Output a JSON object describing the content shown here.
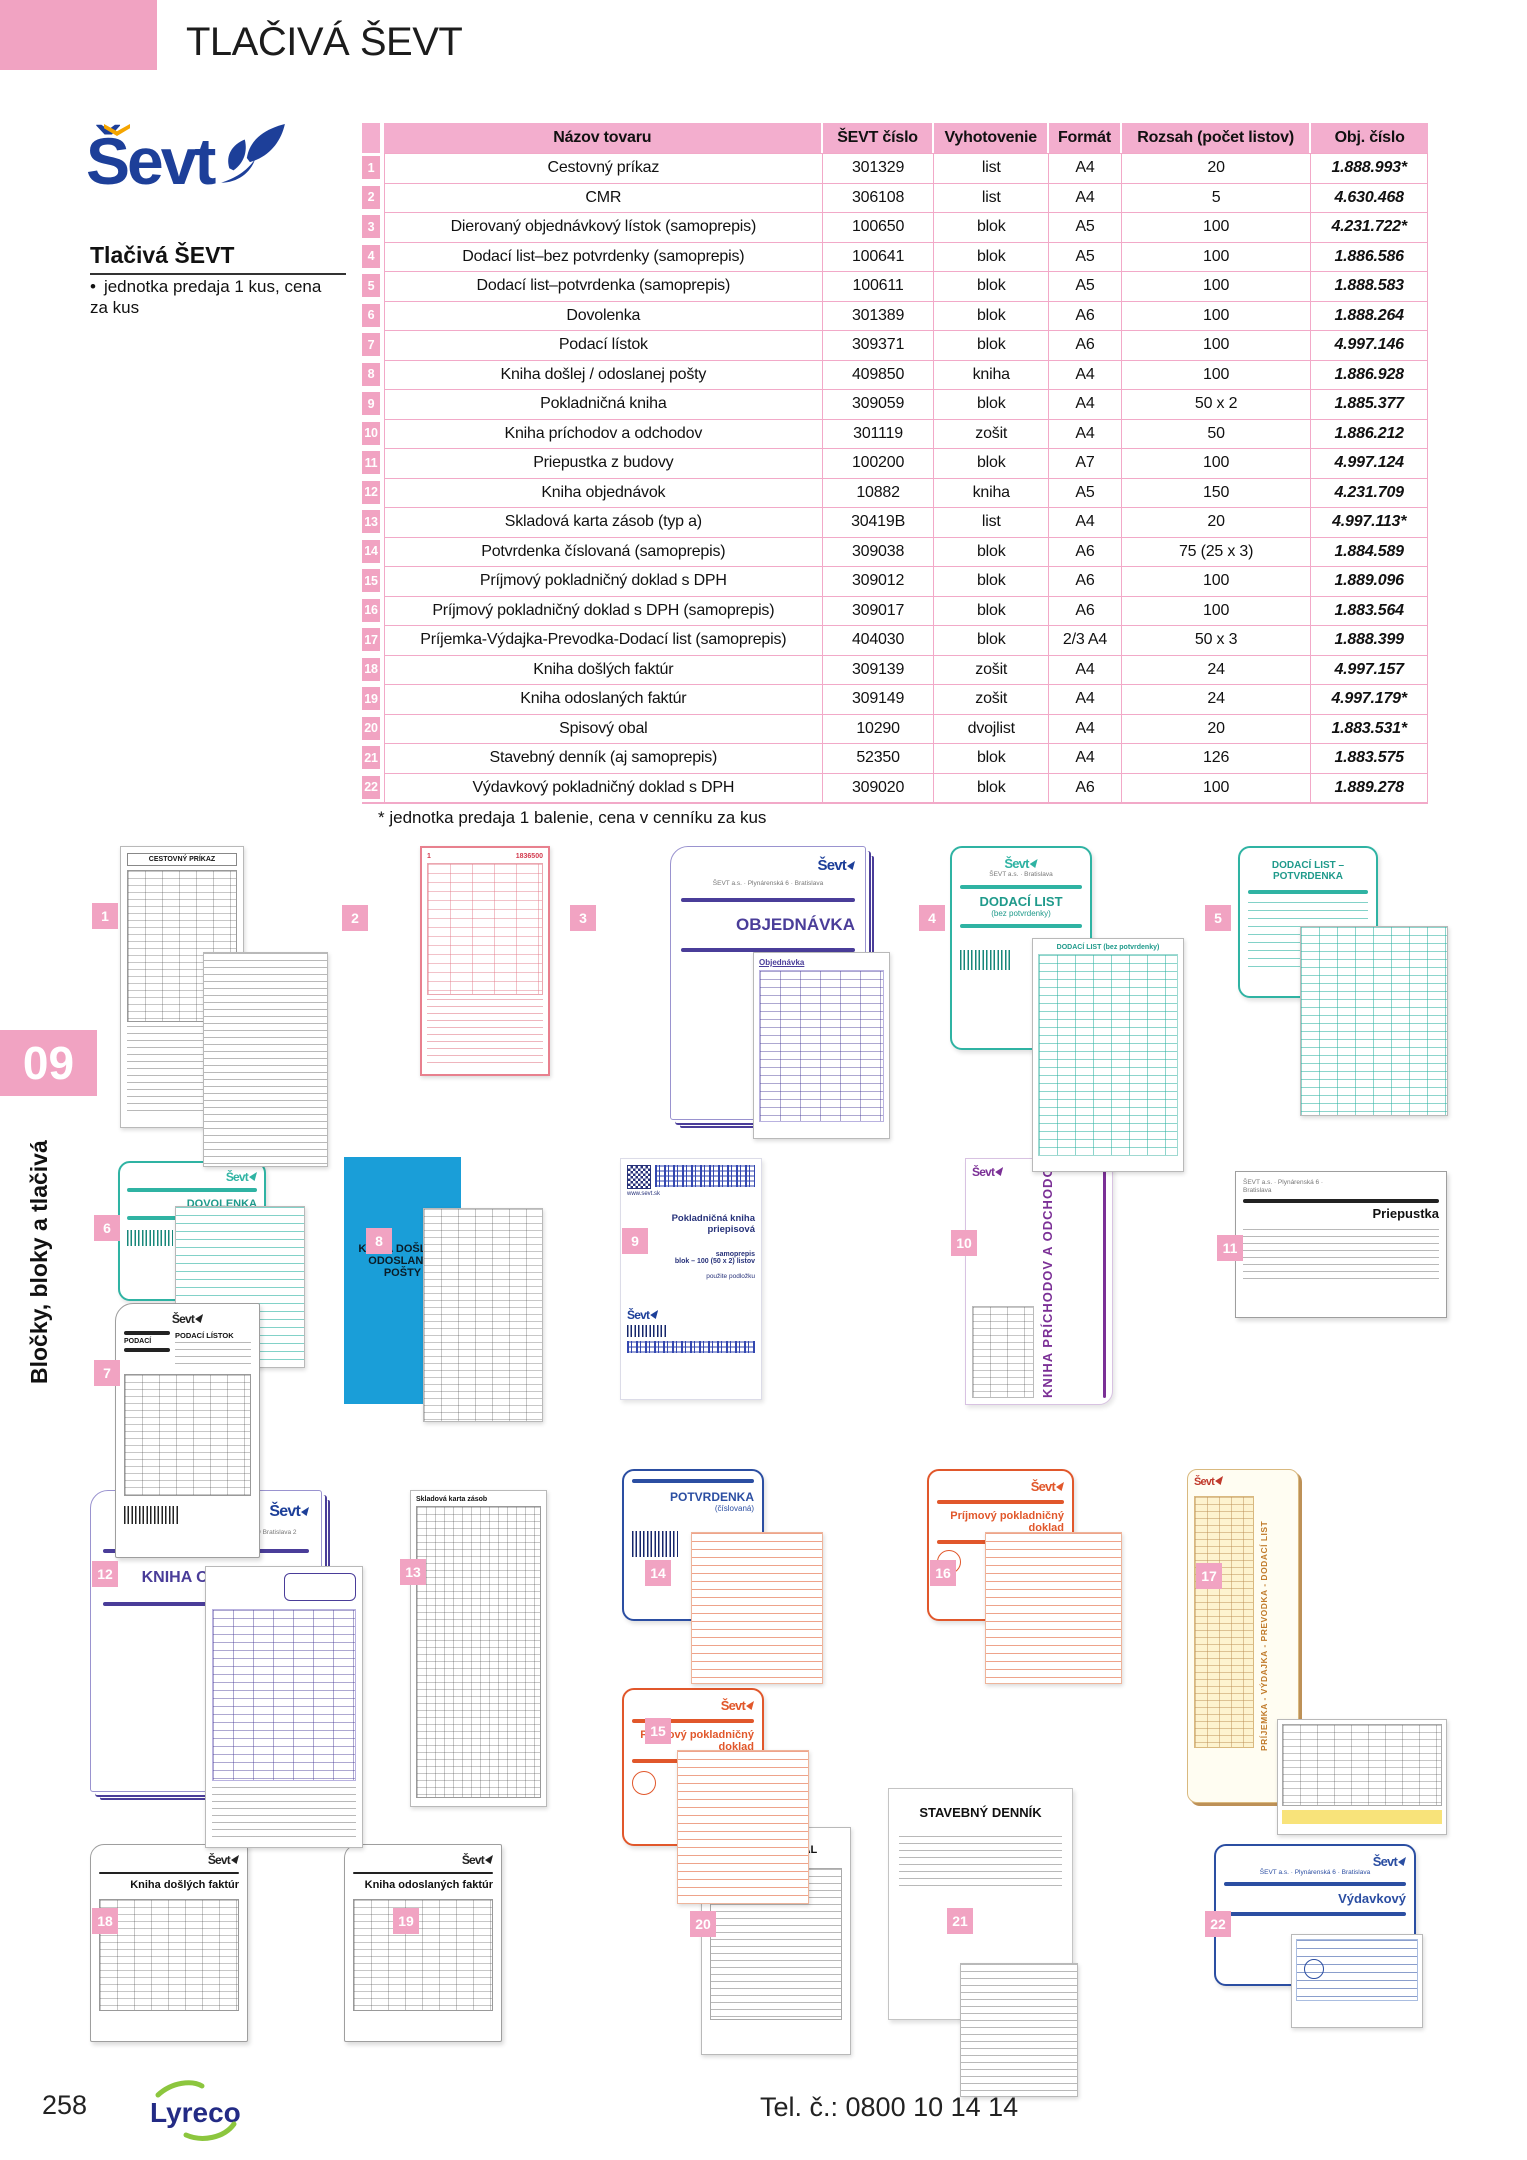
{
  "page": {
    "header_title": "TLAČIVÁ ŠEVT"
  },
  "brand": {
    "logo_text": "Ševt",
    "heading": "Tlačivá ŠEVT",
    "bullet": "jednotka predaja 1 kus, cena za kus"
  },
  "sidebar": {
    "chapter": "09",
    "label": "Bločky, bloky a tlačivá"
  },
  "table": {
    "headers": {
      "name": "Názov tovaru",
      "sevt": "ŠEVT číslo",
      "vyh": "Vyhotovenie",
      "fmt": "Formát",
      "roz": "Rozsah (počet listov)",
      "obj": "Obj. číslo"
    },
    "rows": [
      {
        "num": "1",
        "name": "Cestovný príkaz",
        "sevt": "301329",
        "vyh": "list",
        "fmt": "A4",
        "roz": "20",
        "obj": "1.888.993*"
      },
      {
        "num": "2",
        "name": "CMR",
        "sevt": "306108",
        "vyh": "list",
        "fmt": "A4",
        "roz": "5",
        "obj": "4.630.468"
      },
      {
        "num": "3",
        "name": "Dierovaný objednávkový lístok (samoprepis)",
        "sevt": "100650",
        "vyh": "blok",
        "fmt": "A5",
        "roz": "100",
        "obj": "4.231.722*"
      },
      {
        "num": "4",
        "name": "Dodací list–bez potvrdenky (samoprepis)",
        "sevt": "100641",
        "vyh": "blok",
        "fmt": "A5",
        "roz": "100",
        "obj": "1.886.586"
      },
      {
        "num": "5",
        "name": "Dodací list–potvrdenka (samoprepis)",
        "sevt": "100611",
        "vyh": "blok",
        "fmt": "A5",
        "roz": "100",
        "obj": "1.888.583"
      },
      {
        "num": "6",
        "name": "Dovolenka",
        "sevt": "301389",
        "vyh": "blok",
        "fmt": "A6",
        "roz": "100",
        "obj": "1.888.264"
      },
      {
        "num": "7",
        "name": "Podací lístok",
        "sevt": "309371",
        "vyh": "blok",
        "fmt": "A6",
        "roz": "100",
        "obj": "4.997.146"
      },
      {
        "num": "8",
        "name": "Kniha došlej / odoslanej pošty",
        "sevt": "409850",
        "vyh": "kniha",
        "fmt": "A4",
        "roz": "100",
        "obj": "1.886.928"
      },
      {
        "num": "9",
        "name": "Pokladničná kniha",
        "sevt": "309059",
        "vyh": "blok",
        "fmt": "A4",
        "roz": "50 x 2",
        "obj": "1.885.377"
      },
      {
        "num": "10",
        "name": "Kniha príchodov a odchodov",
        "sevt": "301119",
        "vyh": "zošit",
        "fmt": "A4",
        "roz": "50",
        "obj": "1.886.212"
      },
      {
        "num": "11",
        "name": "Priepustka z budovy",
        "sevt": "100200",
        "vyh": "blok",
        "fmt": "A7",
        "roz": "100",
        "obj": "4.997.124"
      },
      {
        "num": "12",
        "name": "Kniha objednávok",
        "sevt": "10882",
        "vyh": "kniha",
        "fmt": "A5",
        "roz": "150",
        "obj": "4.231.709"
      },
      {
        "num": "13",
        "name": "Skladová karta zásob (typ a)",
        "sevt": "30419B",
        "vyh": "list",
        "fmt": "A4",
        "roz": "20",
        "obj": "4.997.113*"
      },
      {
        "num": "14",
        "name": "Potvrdenka číslovaná (samoprepis)",
        "sevt": "309038",
        "vyh": "blok",
        "fmt": "A6",
        "roz": "75 (25 x 3)",
        "obj": "1.884.589"
      },
      {
        "num": "15",
        "name": "Príjmový pokladničný doklad s DPH",
        "sevt": "309012",
        "vyh": "blok",
        "fmt": "A6",
        "roz": "100",
        "obj": "1.889.096"
      },
      {
        "num": "16",
        "name": "Príjmový pokladničný doklad s DPH (samoprepis)",
        "sevt": "309017",
        "vyh": "blok",
        "fmt": "A6",
        "roz": "100",
        "obj": "1.883.564"
      },
      {
        "num": "17",
        "name": "Príjemka-Výdajka-Prevodka-Dodací list (samoprepis)",
        "sevt": "404030",
        "vyh": "blok",
        "fmt": "2/3 A4",
        "roz": "50 x 3",
        "obj": "1.888.399"
      },
      {
        "num": "18",
        "name": "Kniha došlých faktúr",
        "sevt": "309139",
        "vyh": "zošit",
        "fmt": "A4",
        "roz": "24",
        "obj": "4.997.157"
      },
      {
        "num": "19",
        "name": "Kniha odoslaných faktúr",
        "sevt": "309149",
        "vyh": "zošit",
        "fmt": "A4",
        "roz": "24",
        "obj": "4.997.179*"
      },
      {
        "num": "20",
        "name": "Spisový obal",
        "sevt": "10290",
        "vyh": "dvojlist",
        "fmt": "A4",
        "roz": "20",
        "obj": "1.883.531*"
      },
      {
        "num": "21",
        "name": "Stavebný denník (aj samoprepis)",
        "sevt": "52350",
        "vyh": "blok",
        "fmt": "A4",
        "roz": "126",
        "obj": "1.883.575"
      },
      {
        "num": "22",
        "name": "Výdavkový pokladničný doklad s DPH",
        "sevt": "309020",
        "vyh": "blok",
        "fmt": "A6",
        "roz": "100",
        "obj": "1.889.278"
      }
    ],
    "footnote": "* jednotka predaja 1 balenie, cena v cenníku za kus"
  },
  "products": [
    {
      "num": "1",
      "caption": "CESTOVNÝ PRÍKAZ"
    },
    {
      "num": "2",
      "caption": "1836500"
    },
    {
      "num": "3",
      "caption": "OBJEDNÁVKA",
      "overlay_caption": "Objednávka"
    },
    {
      "num": "4",
      "caption": "DODACÍ LIST",
      "sub": "(bez potvrdenky)",
      "overlay_caption": "DODACÍ LIST (bez potvrdenky)"
    },
    {
      "num": "5",
      "caption": "DODACÍ LIST – POTVRDENKA"
    },
    {
      "num": "6",
      "caption": "DOVOLENKA"
    },
    {
      "num": "7",
      "caption": "PODACÍ LÍSTOK",
      "side": "PODACÍ"
    },
    {
      "num": "8",
      "caption": "KNIHA DOŠLEJ - ODOSLANEJ POŠTY"
    },
    {
      "num": "9",
      "caption": "Pokladničná kniha priepisová",
      "sub": "samoprepis",
      "sub2": "blok – 100 (50 x 2) listov",
      "sub3": "použite podložku",
      "url": "www.sevt.sk"
    },
    {
      "num": "10",
      "caption": "KNIHA PRÍCHODOV A ODCHODOV"
    },
    {
      "num": "11",
      "caption": "Priepustka"
    },
    {
      "num": "12",
      "caption": "KNIHA OBJEDNÁVOK"
    },
    {
      "num": "13",
      "caption": "Skladová karta zásob"
    },
    {
      "num": "14",
      "caption": "POTVRDENKA",
      "sub": "(číslovaná)"
    },
    {
      "num": "15",
      "caption": "Príjmový pokladničný doklad"
    },
    {
      "num": "16",
      "caption": "Príjmový pokladničný doklad"
    },
    {
      "num": "17",
      "caption": "PRÍJEMKA - VÝDAJKA - PREVODKA - DODACÍ LIST"
    },
    {
      "num": "18",
      "caption": "Kniha došlých faktúr"
    },
    {
      "num": "19",
      "caption": "Kniha odoslaných faktúr"
    },
    {
      "num": "20",
      "caption": "SPISOVÝ OBAL"
    },
    {
      "num": "21",
      "caption": "STAVEBNÝ DENNÍK"
    },
    {
      "num": "22",
      "caption": "Výdavkový"
    }
  ],
  "footer": {
    "page_number": "258",
    "logo": "Lyreco",
    "phone": "Tel. č.: 0800 10 14 14"
  },
  "colors": {
    "accent_pink": "#F1A3C2",
    "header_pink": "#F3AECE",
    "sevt_blue": "#1D3F99",
    "teal": "#2FB3A3",
    "purple": "#4A3D99",
    "violet": "#7B3096",
    "cyan": "#1A9ED8",
    "orange": "#E1572B",
    "blue": "#2B4EA2",
    "tan": "#BD9157",
    "lyreco_blue": "#232B85",
    "lyreco_green": "#8CC63E"
  }
}
